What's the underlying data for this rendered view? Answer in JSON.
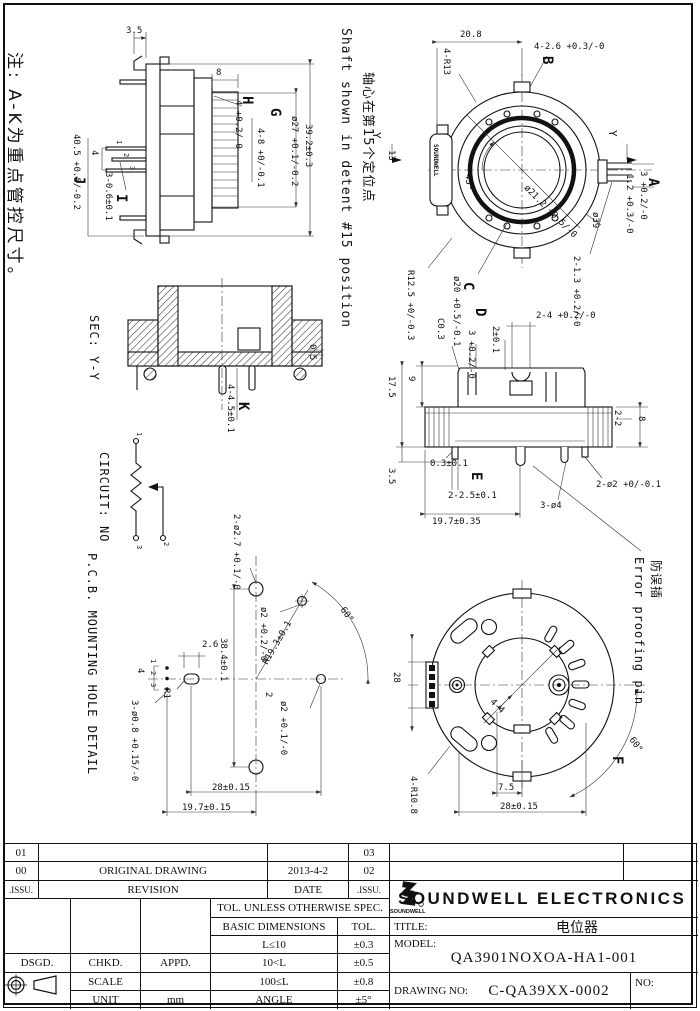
{
  "notes": {
    "main": "注: A-K为重点管控尺寸。",
    "shaft_en": "Shaft shown in detent #15 position",
    "shaft_cn": "轴心在第15个定位点",
    "sec": "SEC: Y-Y",
    "circuit": "CIRCUIT: NO",
    "pcb": "P.C.B. MOUNTING HOLE DETAIL",
    "err_cn": "防误插",
    "err_en": "Error proofing pin"
  },
  "side": {
    "d35": "3.5",
    "d8": "8",
    "H": "H",
    "dH": "4 +0.2/-0",
    "G": "G",
    "dG": "ø27 +0.1/-0.2",
    "d392": "39.2±0.3",
    "d48": "4-8 +0/-0.1",
    "p1": "1",
    "p2": "2",
    "p3": "3",
    "d4": "4",
    "d306": "3-0.6±0.1",
    "I": "I",
    "J": "J",
    "d405": "40.5 +0.5/-0.2"
  },
  "front": {
    "d208": "20.8",
    "d4r13": "4-R13",
    "d426": "4-2.6 +0.3/-0",
    "B": "B",
    "y": "Y",
    "d13": "13",
    "d45": "45°",
    "d212": "ø21.2 +0.5/-0",
    "d39": "ø39",
    "d12": "1.2 +0.3/-0",
    "d3": "3 +0.2/-0",
    "A": "A",
    "d213": "2-1.3 +0.2/-0",
    "d20": "ø20 +0.5/-0.1",
    "C": "C",
    "dr125": "R12.5 +0/-0.3",
    "brand": "SOUNDWELL"
  },
  "sec": {
    "d05": "0.5",
    "d445": "4-4.5±0.1",
    "K": "K"
  },
  "circuit": {
    "t1": "1",
    "t2": "2",
    "t3": "3"
  },
  "pcb": {
    "d227": "2-ø2.7 +0.1/-0",
    "do2a": "ø2 +0.2/-0",
    "do2b": "ø2 +0.1/-0",
    "dr193": "R19.3±0.1",
    "d60": "60°",
    "d384": "38.4±0.1",
    "d26": "2.6",
    "d2": "2",
    "r1": "R1",
    "d308": "3-ø0.8 +0.15/-0",
    "p1": "1",
    "p2": "2",
    "p3": "3",
    "d4": "4",
    "d28": "28±0.15",
    "d197": "19.7±0.15"
  },
  "ed": {
    "c03": "C0.3",
    "d302": "3 +0.2/-0",
    "d201": "2±0.1",
    "D": "D",
    "d24": "2-4 +0.2/-0",
    "d9": "9",
    "d175": "17.5",
    "d35": "3.5",
    "d03": "0.3±0.1",
    "E": "E",
    "d225": "2-2.5±0.1",
    "d22": "2-2",
    "d8": "8",
    "d2o2": "2-ø2 +0/-0.1",
    "d3o4": "3-ø4",
    "d197": "19.7±0.35"
  },
  "back": {
    "d28": "28",
    "d44": "4-4",
    "d4r108": "4-R10.8",
    "d75": "7.5",
    "d28015": "28±0.15",
    "d60": "60°",
    "F": "F"
  },
  "tb": {
    "r01": "01",
    "r00": "00",
    "r03": "03",
    "r02": "02",
    "issu": ".ISSU.",
    "revision": "REVISION",
    "date_lbl": "DATE",
    "issu2": ".ISSU.",
    "orig": "ORIGINAL DRAWING",
    "date": "2013-4-2",
    "tol_hdr": "TOL. UNLESS OTHERWISE SPEC.",
    "basic": "BASIC DIMENSIONS",
    "tol": "TOL.",
    "l1": "L≤10",
    "t1": "±0.3",
    "l2": "10<L",
    "t2": "±0.5",
    "l3": "100≤L",
    "t3": "±0.8",
    "l4": "ANGLE",
    "t4": "±5°",
    "dsgd": "DSGD.",
    "chkd": "CHKD.",
    "appd": "APPD.",
    "scale": "SCALE",
    "unit": "UNIT",
    "mm": "mm",
    "company": "SOUNDWELL ELECTRONICS",
    "logo_txt": "SOUNDWELL",
    "title_lbl": "TITLE:",
    "title": "电位器",
    "model_lbl": "MODEL:",
    "model": "QA3901NOXOA-HA1-001",
    "dwg_lbl": "DRAWING NO:",
    "dwg": "C-QA39XX-0002",
    "no_lbl": "NO:"
  }
}
